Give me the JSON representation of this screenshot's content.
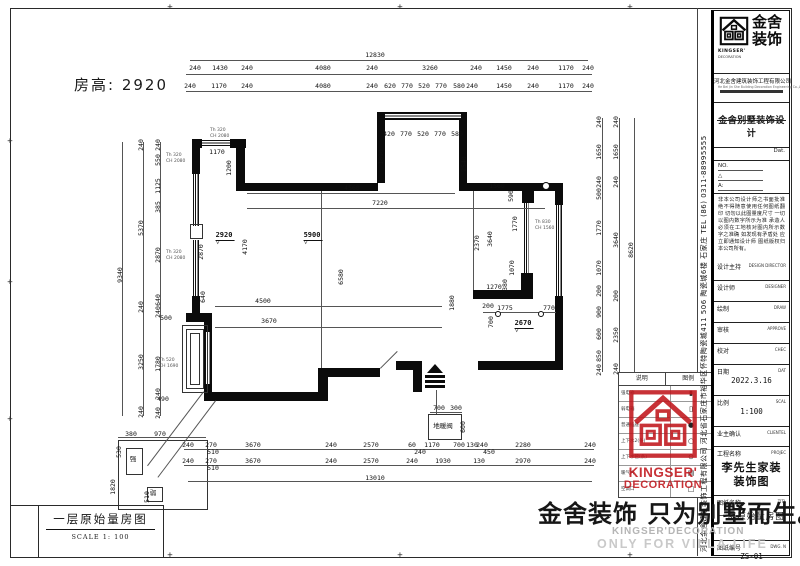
{
  "room_height_label": "房高: 2920",
  "title_box": {
    "title": "一层原始量房图",
    "scale": "SCALE 1: 100"
  },
  "watermark": {
    "cn": "金舍装饰 只为别墅而生。",
    "en1": "KINGSER'DECORATION",
    "en2": "ONLY FOR VILLA LIFE"
  },
  "stamp": {
    "line1": "KINGSER'",
    "line2": "DECORATION"
  },
  "titleblock": {
    "logo_cn": "金舍装饰",
    "logo_en1": "KINGSER'",
    "logo_en2": "DECORATION",
    "company": "河北金舍建筑装饰工程有限公司",
    "company_en": "He Bei Jin She Building Decoration Engineering Co.,L",
    "dept_title": "金舍别墅装饰设计",
    "date_label": "Dat.",
    "no_label": "NO.",
    "tri_label": "△",
    "a_label": "A:",
    "notice": "非本公司设计师之书面批准 绝不得随意使用任何图纸翻印 切勿以此图量度尺寸 一切以图内数字所示为准 承造人必须在工地核对图内所示数字之准确 如发现有矛盾处 应立即通知设计师 图纸版权归本公司所有。",
    "side_text": "河北金舍建筑装饰工程有限公司 河北省石家庄市裕华区怀特陶瓷城411 506 陶瓷城6楼 石家庄 TEL (86) 0311-88995555",
    "rows": [
      {
        "cn": "设计主持",
        "en": "DESIGN DIRECTOR",
        "h": 20
      },
      {
        "cn": "设计师",
        "en": "DESIGNER",
        "h": 20
      },
      {
        "cn": "绘制",
        "en": "DRAW",
        "h": 20
      },
      {
        "cn": "审核",
        "en": "APPROVE",
        "h": 20
      },
      {
        "cn": "校对",
        "en": "CHEC",
        "h": 20
      },
      {
        "cn": "日期",
        "en": "DAT",
        "h": 30,
        "val": [
          "2022.3.16"
        ]
      },
      {
        "cn": "比例",
        "en": "SCAL",
        "h": 30,
        "val": [
          "1:100"
        ]
      },
      {
        "cn": "业主确认",
        "en": "CLIENTEL",
        "h": 19
      },
      {
        "cn": "工程名称",
        "en": "PROJEC",
        "h": 48,
        "val": [
          "李先生家装",
          "装饰图"
        ],
        "style": "big"
      },
      {
        "cn": "图纸名称",
        "en": "TITL",
        "h": 44,
        "val": [
          "一层原始量房图"
        ],
        "style": "mid"
      },
      {
        "cn": "图纸编号",
        "en": "DWG. N",
        "h": 31,
        "val": [
          "ZS-01"
        ]
      }
    ]
  },
  "legend": {
    "col1": "说明",
    "col2": "图例",
    "rows": [
      {
        "label": "强电箱",
        "sym": "▮"
      },
      {
        "label": "弱电箱",
        "sym": "▯"
      },
      {
        "label": "普通插座",
        "sym": "●"
      },
      {
        "label": "上下水2(条)",
        "sym": "○"
      },
      {
        "label": "上下水管(条)",
        "sym": "⊙"
      },
      {
        "label": "暖气片",
        "sym": "▤"
      },
      {
        "label": "空调口",
        "sym": "□"
      }
    ]
  },
  "plan": {
    "geometry": {
      "walls": [
        [
          192,
          139,
          10,
          9
        ],
        [
          230,
          139,
          16,
          9
        ],
        [
          192,
          148,
          8,
          26
        ],
        [
          192,
          296,
          8,
          19
        ],
        [
          186,
          313,
          26,
          9
        ],
        [
          204,
          322,
          8,
          72
        ],
        [
          204,
          392,
          122,
          9
        ],
        [
          318,
          368,
          10,
          33
        ],
        [
          318,
          368,
          62,
          9
        ],
        [
          396,
          361,
          26,
          9
        ],
        [
          413,
          361,
          9,
          31
        ],
        [
          478,
          361,
          10,
          9
        ],
        [
          488,
          361,
          75,
          9
        ],
        [
          555,
          296,
          8,
          74
        ],
        [
          555,
          187,
          8,
          18
        ],
        [
          459,
          183,
          104,
          8
        ],
        [
          236,
          183,
          142,
          8
        ],
        [
          377,
          112,
          8,
          71
        ],
        [
          377,
          112,
          90,
          8
        ],
        [
          459,
          112,
          8,
          79
        ],
        [
          236,
          148,
          9,
          38
        ],
        [
          522,
          191,
          12,
          12
        ],
        [
          521,
          273,
          12,
          17
        ],
        [
          473,
          290,
          60,
          9
        ]
      ],
      "windows": [
        [
          202,
          140,
          28,
          6,
          "h"
        ],
        [
          385,
          113,
          76,
          6,
          "h"
        ],
        [
          193,
          174,
          6,
          52,
          "v"
        ],
        [
          193,
          240,
          6,
          56,
          "v"
        ],
        [
          205,
          332,
          5,
          52,
          "v"
        ],
        [
          556,
          205,
          6,
          91,
          "v"
        ],
        [
          524,
          203,
          5,
          70,
          "v"
        ]
      ],
      "boxes": [
        [
          182,
          325,
          24,
          66
        ],
        [
          186,
          329,
          16,
          58
        ],
        [
          190,
          333,
          8,
          50
        ],
        [
          190,
          224,
          11,
          13
        ],
        [
          118,
          440,
          88,
          68
        ],
        [
          126,
          448,
          15,
          25
        ],
        [
          147,
          487,
          14,
          13
        ],
        [
          428,
          414,
          32,
          24
        ]
      ],
      "lines": [
        [
          190,
          60,
          588,
          60
        ],
        [
          186,
          74,
          592,
          74
        ],
        [
          186,
          91,
          592,
          91
        ],
        [
          184,
          449,
          594,
          449
        ],
        [
          184,
          465,
          594,
          465
        ],
        [
          188,
          481,
          592,
          481
        ],
        [
          122,
          142,
          122,
          416
        ],
        [
          143,
          142,
          143,
          416
        ],
        [
          160,
          142,
          160,
          416
        ],
        [
          602,
          118,
          602,
          372
        ],
        [
          619,
          118,
          619,
          372
        ],
        [
          634,
          118,
          634,
          372
        ],
        [
          247,
          193,
          455,
          193
        ],
        [
          247,
          208,
          545,
          208
        ],
        [
          215,
          306,
          442,
          306
        ],
        [
          215,
          327,
          442,
          327
        ],
        [
          483,
          312,
          556,
          312
        ],
        [
          118,
          437,
          206,
          437
        ],
        [
          430,
          412,
          462,
          412
        ],
        [
          321,
          191,
          321,
          368
        ],
        [
          473,
          191,
          473,
          290
        ],
        [
          204,
          392,
          148,
          466
        ],
        [
          216,
          401,
          158,
          478
        ],
        [
          380,
          368,
          397,
          351
        ],
        [
          436,
          390,
          436,
          414
        ]
      ],
      "dims": [
        [
          "12830",
          375,
          55,
          0
        ],
        [
          "240",
          195,
          68,
          0
        ],
        [
          "1430",
          220,
          68,
          0
        ],
        [
          "240",
          247,
          68,
          0
        ],
        [
          "4080",
          323,
          68,
          0
        ],
        [
          "240",
          372,
          68,
          0
        ],
        [
          "3260",
          430,
          68,
          0
        ],
        [
          "240",
          476,
          68,
          0
        ],
        [
          "1450",
          504,
          68,
          0
        ],
        [
          "240",
          533,
          68,
          0
        ],
        [
          "1170",
          566,
          68,
          0
        ],
        [
          "240",
          588,
          68,
          0
        ],
        [
          "240",
          190,
          86,
          0
        ],
        [
          "1170",
          219,
          86,
          0
        ],
        [
          "240",
          247,
          86,
          0
        ],
        [
          "4080",
          323,
          86,
          0
        ],
        [
          "240",
          372,
          86,
          0
        ],
        [
          "620",
          390,
          86,
          0
        ],
        [
          "770",
          407,
          86,
          0
        ],
        [
          "520",
          424,
          86,
          0
        ],
        [
          "770",
          441,
          86,
          0
        ],
        [
          "580",
          459,
          86,
          0
        ],
        [
          "240",
          472,
          86,
          0
        ],
        [
          "1450",
          504,
          86,
          0
        ],
        [
          "240",
          533,
          86,
          0
        ],
        [
          "1170",
          566,
          86,
          0
        ],
        [
          "240",
          588,
          86,
          0
        ],
        [
          "240",
          188,
          445,
          0
        ],
        [
          "270",
          211,
          445,
          0
        ],
        [
          "3670",
          253,
          445,
          0
        ],
        [
          "240",
          331,
          445,
          0
        ],
        [
          "2570",
          371,
          445,
          0
        ],
        [
          "60",
          412,
          445,
          0
        ],
        [
          "1170",
          432,
          445,
          0
        ],
        [
          "700",
          459,
          445,
          0
        ],
        [
          "130",
          472,
          445,
          0
        ],
        [
          "240",
          482,
          445,
          0
        ],
        [
          "2280",
          523,
          445,
          0
        ],
        [
          "240",
          590,
          445,
          0
        ],
        [
          "510",
          213,
          452,
          0
        ],
        [
          "240",
          420,
          452,
          0
        ],
        [
          "450",
          489,
          452,
          0
        ],
        [
          "240",
          188,
          461,
          0
        ],
        [
          "270",
          211,
          461,
          0
        ],
        [
          "3670",
          253,
          461,
          0
        ],
        [
          "240",
          331,
          461,
          0
        ],
        [
          "2570",
          371,
          461,
          0
        ],
        [
          "240",
          412,
          461,
          0
        ],
        [
          "1930",
          443,
          461,
          0
        ],
        [
          "130",
          479,
          461,
          0
        ],
        [
          "2970",
          523,
          461,
          0
        ],
        [
          "240",
          590,
          461,
          0
        ],
        [
          "510",
          213,
          468,
          0
        ],
        [
          "13010",
          375,
          478,
          0
        ],
        [
          "9340",
          120,
          275,
          1
        ],
        [
          "240",
          141,
          145,
          1
        ],
        [
          "5370",
          141,
          228,
          1
        ],
        [
          "240",
          141,
          307,
          1
        ],
        [
          "3250",
          141,
          362,
          1
        ],
        [
          "240",
          141,
          412,
          1
        ],
        [
          "240",
          158,
          145,
          1
        ],
        [
          "550",
          158,
          160,
          1
        ],
        [
          "1125",
          158,
          186,
          1
        ],
        [
          "385",
          158,
          207,
          1
        ],
        [
          "2870",
          158,
          255,
          1
        ],
        [
          "640",
          158,
          300,
          1
        ],
        [
          "240",
          158,
          312,
          1
        ],
        [
          "1780",
          158,
          364,
          1
        ],
        [
          "240",
          158,
          394,
          1
        ],
        [
          "240",
          158,
          413,
          1
        ],
        [
          "500",
          166,
          318,
          0
        ],
        [
          "490",
          163,
          399,
          0
        ],
        [
          "240",
          599,
          122,
          1
        ],
        [
          "1650",
          599,
          152,
          1
        ],
        [
          "240",
          599,
          182,
          1
        ],
        [
          "500",
          599,
          194,
          1
        ],
        [
          "1770",
          599,
          228,
          1
        ],
        [
          "1070",
          599,
          268,
          1
        ],
        [
          "200",
          599,
          291,
          1
        ],
        [
          "900",
          599,
          312,
          1
        ],
        [
          "600",
          599,
          334,
          1
        ],
        [
          "850",
          599,
          356,
          1
        ],
        [
          "240",
          599,
          370,
          1
        ],
        [
          "240",
          616,
          122,
          1
        ],
        [
          "1650",
          616,
          152,
          1
        ],
        [
          "240",
          616,
          182,
          1
        ],
        [
          "3640",
          616,
          240,
          1
        ],
        [
          "200",
          616,
          296,
          1
        ],
        [
          "2350",
          616,
          335,
          1
        ],
        [
          "240",
          616,
          369,
          1
        ],
        [
          "8620",
          631,
          250,
          1
        ],
        [
          "1170",
          217,
          152,
          0
        ],
        [
          "1200",
          229,
          168,
          1
        ],
        [
          "4560",
          352,
          188,
          0
        ],
        [
          "7220",
          380,
          203,
          0
        ],
        [
          "1890",
          381,
          157,
          1
        ],
        [
          "420",
          389,
          134,
          0
        ],
        [
          "770",
          406,
          134,
          0
        ],
        [
          "520",
          423,
          134,
          0
        ],
        [
          "770",
          440,
          134,
          0
        ],
        [
          "580",
          457,
          134,
          0
        ],
        [
          "2540",
          464,
          164,
          1
        ],
        [
          "1560",
          497,
          186,
          0
        ],
        [
          "590",
          511,
          196,
          1
        ],
        [
          "1770",
          515,
          224,
          1
        ],
        [
          "2370",
          477,
          243,
          1
        ],
        [
          "3640",
          490,
          239,
          1
        ],
        [
          "1070",
          512,
          268,
          1
        ],
        [
          "380",
          505,
          285,
          1
        ],
        [
          "1270",
          494,
          287,
          0
        ],
        [
          "1880",
          452,
          303,
          1
        ],
        [
          "200",
          488,
          306,
          0
        ],
        [
          "1775",
          505,
          308,
          0
        ],
        [
          "770",
          549,
          308,
          0
        ],
        [
          "700",
          491,
          322,
          1
        ],
        [
          "4500",
          263,
          301,
          0
        ],
        [
          "3670",
          269,
          321,
          0
        ],
        [
          "6580",
          341,
          277,
          1
        ],
        [
          "4170",
          245,
          247,
          1
        ],
        [
          "2870",
          201,
          252,
          1
        ],
        [
          "640",
          203,
          297,
          1
        ],
        [
          "700",
          439,
          408,
          0
        ],
        [
          "300",
          456,
          408,
          0
        ],
        [
          "600",
          463,
          427,
          1
        ],
        [
          "地暖阀",
          443,
          426,
          0
        ],
        [
          "380",
          131,
          434,
          0
        ],
        [
          "970",
          160,
          434,
          0
        ],
        [
          "530",
          119,
          452,
          1
        ],
        [
          "1820",
          113,
          487,
          1
        ],
        [
          "510",
          147,
          497,
          1
        ],
        [
          "强",
          133,
          459,
          0
        ],
        [
          "弱",
          153,
          493,
          0
        ]
      ],
      "levels": [
        [
          "2920",
          225,
          241
        ],
        [
          "5900",
          313,
          241
        ],
        [
          "2670",
          524,
          329
        ]
      ],
      "tags": [
        [
          "Th 320",
          "CH 2080",
          210,
          128
        ],
        [
          "Th 320",
          "CH 2080",
          166,
          153
        ],
        [
          "Th 320",
          "CH 2080",
          166,
          250
        ],
        [
          "Th 520",
          "CH 1690",
          159,
          358
        ],
        [
          "Th 830",
          "CH 1560",
          535,
          220
        ]
      ],
      "circles": [
        [
          545,
          185,
          3
        ],
        [
          497,
          313,
          2
        ],
        [
          540,
          313,
          2
        ]
      ],
      "ticks": [
        [
          170,
          8
        ],
        [
          400,
          8
        ],
        [
          630,
          8
        ],
        [
          10,
          142
        ],
        [
          10,
          283
        ],
        [
          10,
          420
        ],
        [
          170,
          556
        ],
        [
          400,
          556
        ],
        [
          630,
          556
        ]
      ]
    }
  }
}
